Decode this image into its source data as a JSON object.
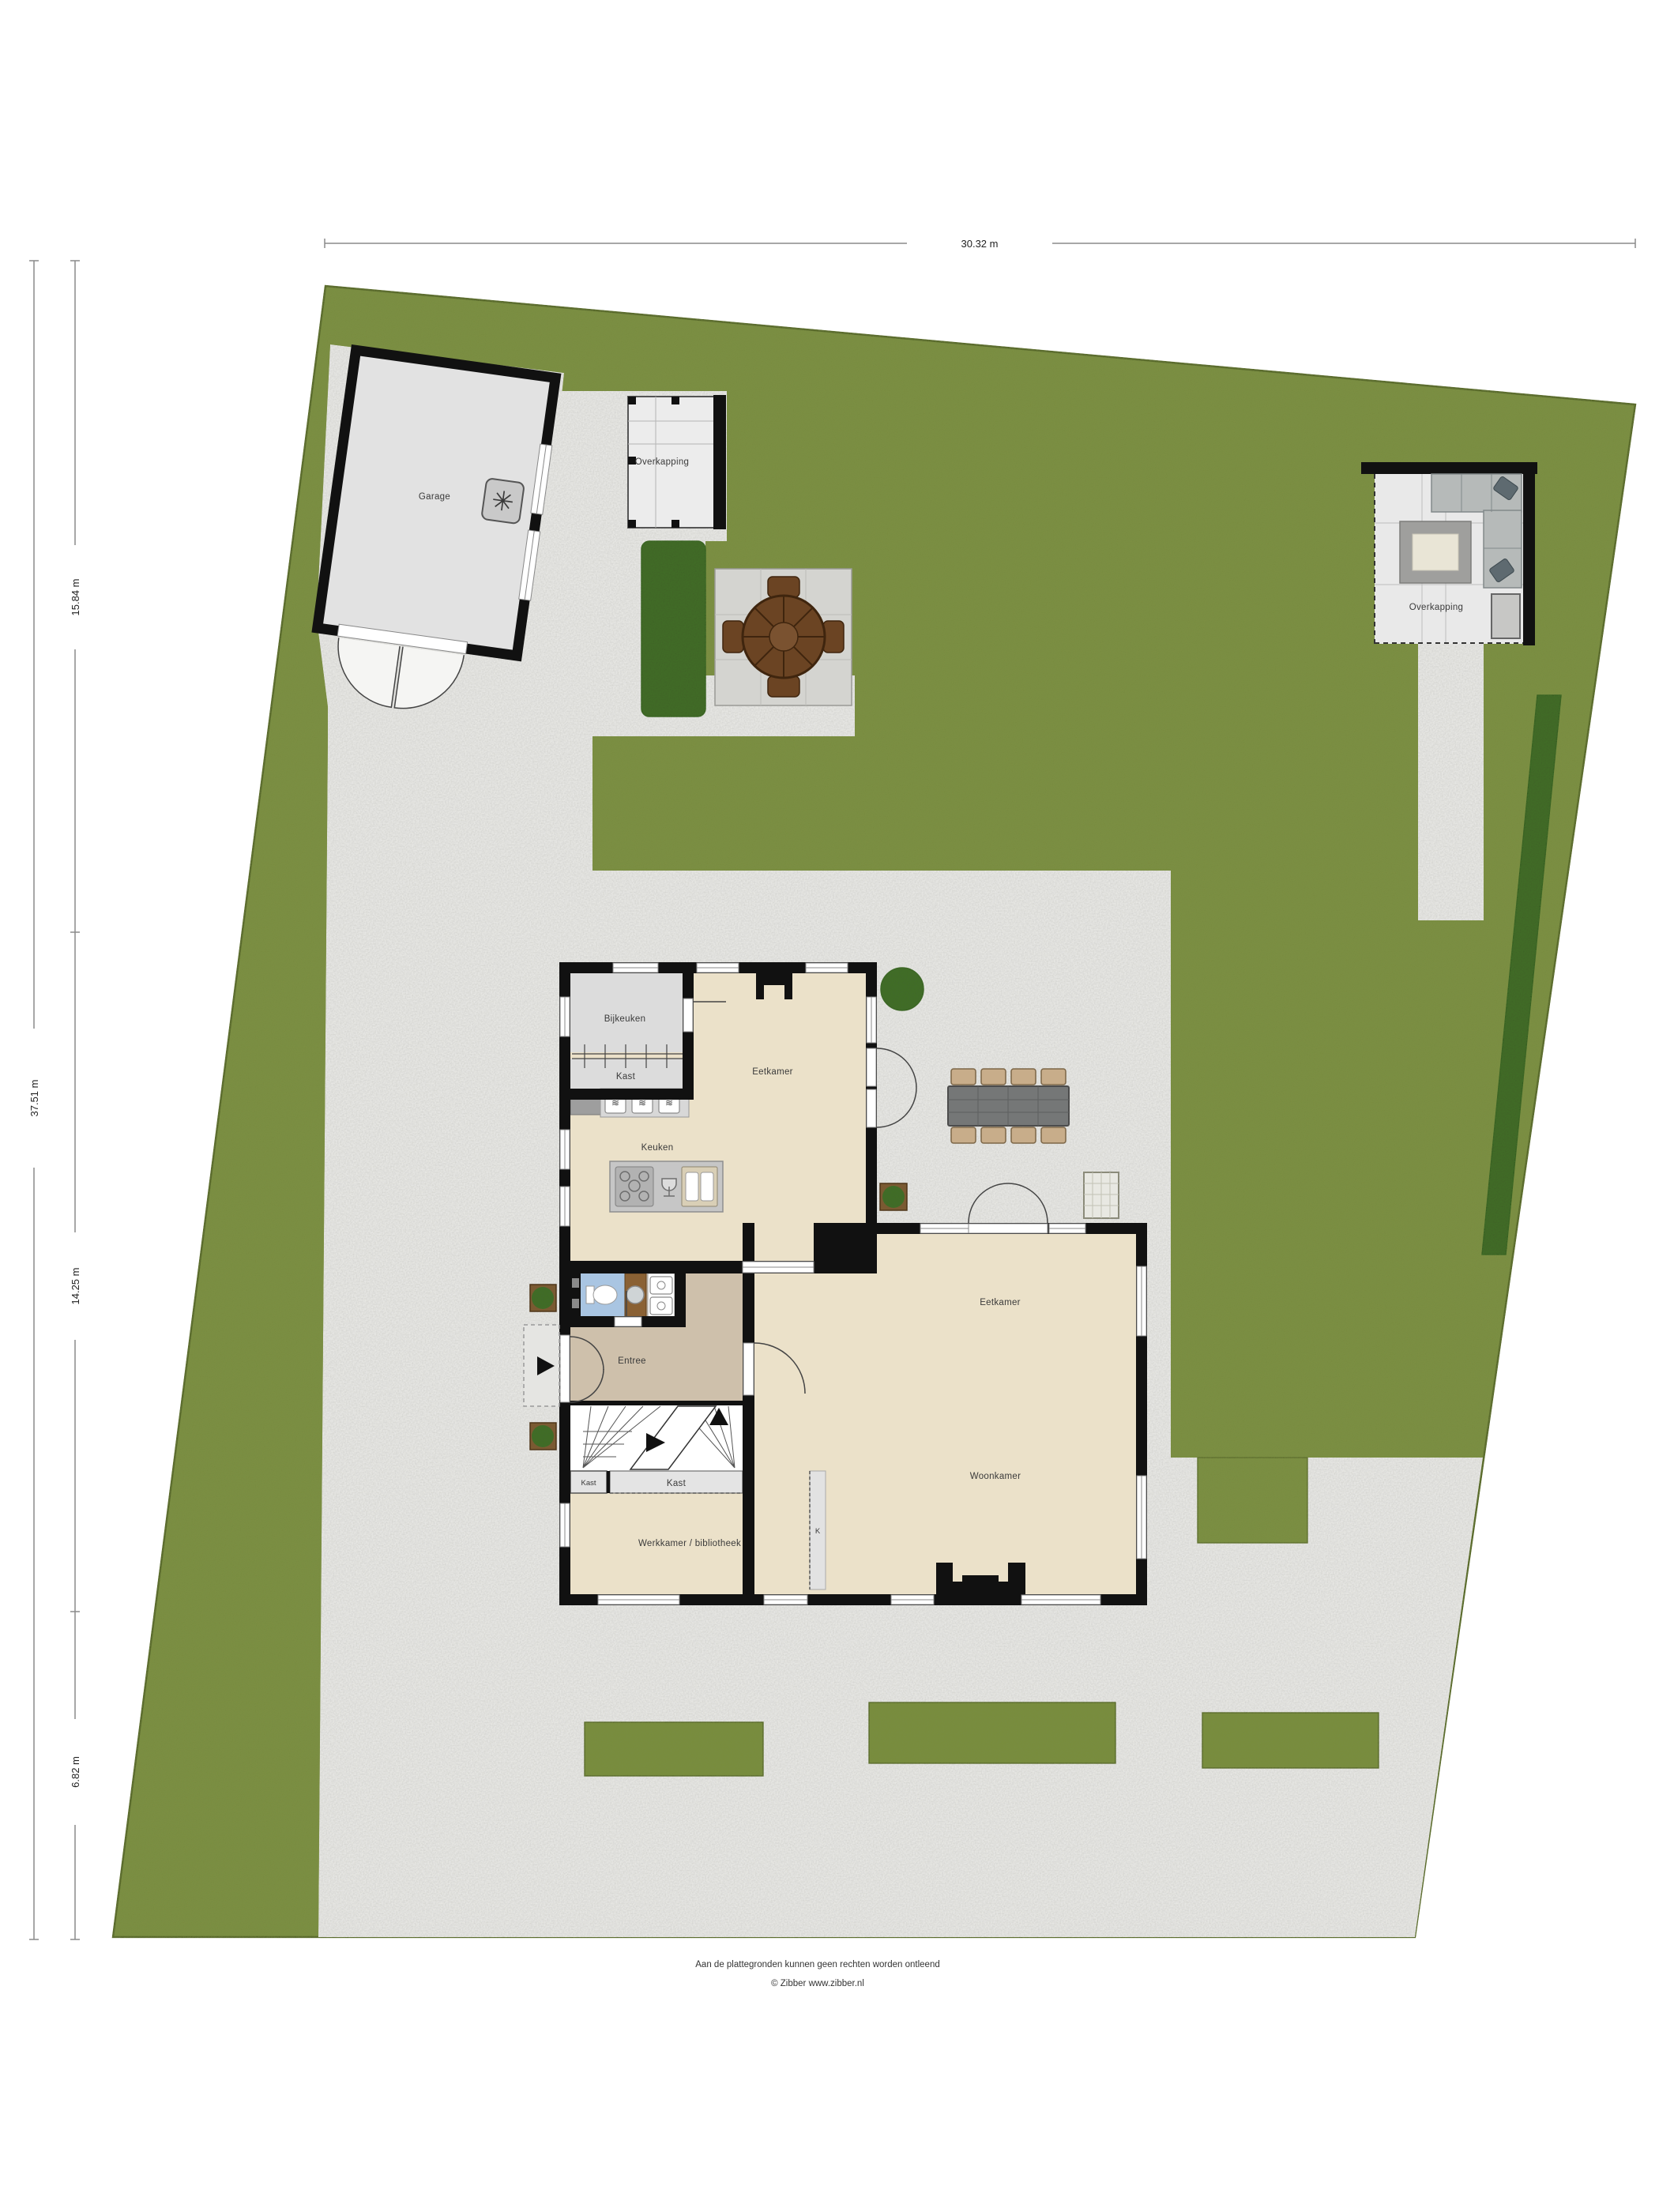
{
  "title": "Situatie plattegrond",
  "dimensions": {
    "top_width": "30.32 m",
    "left_total": "37.51 m",
    "left_segment_1": "15.84 m",
    "left_segment_2": "14.25 m",
    "left_segment_3": "6.82 m"
  },
  "labels": {
    "garage": "Garage",
    "overkapping_west": "Overkapping",
    "overkapping_east": "Overkapping",
    "bijkeuken": "Bijkeuken",
    "kast_bijkeuken": "Kast",
    "eetkamer_noord": "Eetkamer",
    "keuken": "Keuken",
    "entree": "Entree",
    "eetkamer": "Eetkamer",
    "woonkamer": "Woonkamer",
    "kast_klein": "Kast",
    "kast_breed": "Kast",
    "werkkamer": "Werkkamer / bibliotheek",
    "kast_k": "K"
  },
  "footer": {
    "line1": "Aan de plattegronden kunnen geen rechten worden ontleend",
    "line2": "© Zibber www.zibber.nl"
  },
  "colors": {
    "grass": "#7e9143",
    "grass_edge": "#3f4e1b",
    "gravel": "#e6e6e3",
    "hedge": "#3e5b25",
    "wall": "#111111",
    "floor_beige": "#ebe1c9",
    "floor_gray": "#dcdcdc",
    "floor_entree": "#cec0ab",
    "floor_toilet": "#a9c5e2",
    "counter": "#c6c6c6",
    "wood": "#8a6134",
    "table_brown": "#6b4423",
    "sofa_gray": "#b6bab9",
    "garden_table_gray": "#757777",
    "chair_tan": "#c8ad8a"
  }
}
